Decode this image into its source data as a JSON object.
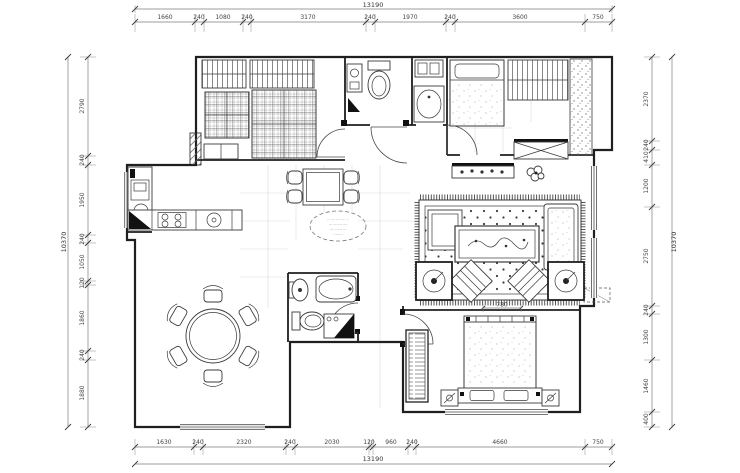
{
  "plan": {
    "title": "apartment-floor-plan",
    "colors": {
      "line": "#1f1f1f",
      "dim_text": "#444444",
      "grid": "#d9d9d9"
    },
    "dims": {
      "top": {
        "total": "13190",
        "segments": [
          "1660",
          "240",
          "1080",
          "240",
          "3170",
          "240",
          "1970",
          "240",
          "3600",
          "750"
        ]
      },
      "bottom": {
        "total": "13190",
        "segments": [
          "1630",
          "240",
          "2320",
          "240",
          "2030",
          "120",
          "960",
          "240",
          "4660",
          "750"
        ]
      },
      "left": {
        "total": "10370",
        "segments": [
          "2790",
          "240",
          "1950",
          "240",
          "1050",
          "120",
          "1860",
          "240",
          "1880"
        ]
      },
      "right": {
        "total": "10370",
        "segments": [
          "2370",
          "240",
          "410",
          "1200",
          "2750",
          "240",
          "1300",
          "1460",
          "400"
        ]
      },
      "bed_clearance": "780"
    },
    "note_lines": [
      "·· ···· ···· ···· ··",
      "··· ········ ····",
      "···· ······ ···",
      "· ······ ·"
    ]
  }
}
